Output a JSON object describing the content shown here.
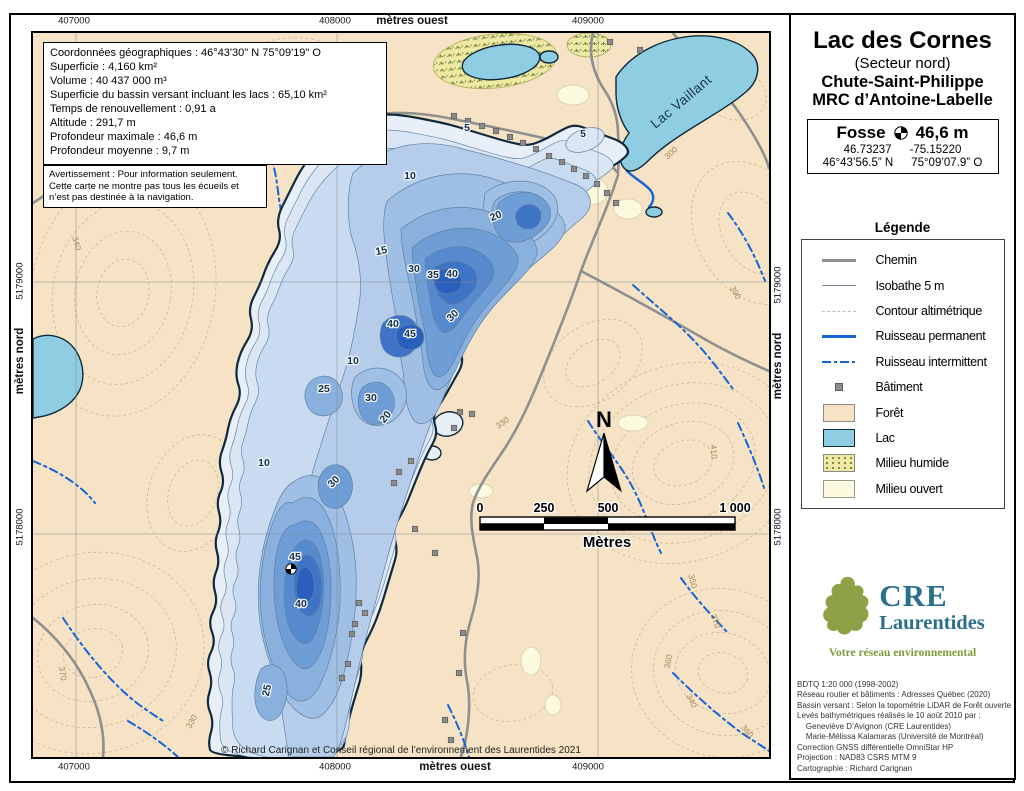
{
  "colors": {
    "forest": "#f6e3c5",
    "lake": "#8fcde3",
    "deep_blue": "#2a5fbd",
    "stream_blue": "#1565d8",
    "road_gray": "#8f8f8f",
    "logo_teal": "#2b6f8e",
    "logo_green": "#7d9c3c"
  },
  "map": {
    "axes": {
      "top": {
        "y": 21,
        "items": [
          {
            "t": "407000",
            "x": 74
          },
          {
            "t": "408000",
            "x": 335
          },
          {
            "t": "mètres ouest",
            "x": 412,
            "unit": true
          },
          {
            "t": "409000",
            "x": 588
          }
        ]
      },
      "bottom": {
        "y": 767,
        "items": [
          {
            "t": "407000",
            "x": 74
          },
          {
            "t": "408000",
            "x": 335
          },
          {
            "t": "mètres ouest",
            "x": 455,
            "unit": true
          },
          {
            "t": "409000",
            "x": 588
          }
        ]
      },
      "left": {
        "x": 20,
        "items": [
          {
            "t": "5179000",
            "y": 281
          },
          {
            "t": "mètres nord",
            "y": 361,
            "unit": true
          },
          {
            "t": "5178000",
            "y": 527
          }
        ]
      },
      "right": {
        "x": 778,
        "items": [
          {
            "t": "5179000",
            "y": 285
          },
          {
            "t": "mètres nord",
            "y": 366,
            "unit": true
          },
          {
            "t": "5178000",
            "y": 527
          }
        ]
      }
    },
    "info_box": {
      "lines": [
        "Coordonnées géographiques : 46°43'30\" N   75°09'19\" O",
        "Superficie : 4,160 km²",
        "Volume : 40 437 000 m³",
        "Superficie du bassin versant incluant les lacs : 65,10 km²",
        "Temps de renouvellement : 0,91 a",
        "Altitude : 291,7 m",
        "Profondeur maximale : 46,6 m",
        "Profondeur moyenne : 9,7 m"
      ]
    },
    "warning_box": {
      "lines": [
        "Avertissement : Pour information seulement.",
        "Cette carte ne montre pas tous les écueils et",
        "n’est pas destinée à la navigation."
      ]
    },
    "copyright": "© Richard Carignan et Conseil régional de l’environnement des Laurentides 2021",
    "lake_vaillant_label": "Lac Vaillant",
    "north_label": "N",
    "scalebar": {
      "ticks": [
        {
          "t": "0",
          "x": 447
        },
        {
          "t": "250",
          "x": 511
        },
        {
          "t": "500",
          "x": 575
        },
        {
          "t": "1 000",
          "x": 702
        }
      ],
      "unit": "Mètres"
    },
    "depth_labels": [
      {
        "v": "5",
        "x": 550,
        "y": 104
      },
      {
        "v": "5",
        "x": 434,
        "y": 98
      },
      {
        "v": "10",
        "x": 377,
        "y": 146
      },
      {
        "v": "15",
        "x": 349,
        "y": 221,
        "r": -12
      },
      {
        "v": "20",
        "x": 464,
        "y": 186,
        "r": -22
      },
      {
        "v": "30",
        "x": 381,
        "y": 239
      },
      {
        "v": "35",
        "x": 400,
        "y": 245
      },
      {
        "v": "40",
        "x": 419,
        "y": 244
      },
      {
        "v": "40",
        "x": 360,
        "y": 294
      },
      {
        "v": "45",
        "x": 377,
        "y": 304
      },
      {
        "v": "30",
        "x": 422,
        "y": 285,
        "r": -45
      },
      {
        "v": "10",
        "x": 320,
        "y": 331
      },
      {
        "v": "25",
        "x": 291,
        "y": 359
      },
      {
        "v": "30",
        "x": 338,
        "y": 368
      },
      {
        "v": "20",
        "x": 355,
        "y": 386,
        "r": -50
      },
      {
        "v": "10",
        "x": 231,
        "y": 433
      },
      {
        "v": "30",
        "x": 303,
        "y": 451,
        "r": -45
      },
      {
        "v": "45",
        "x": 262,
        "y": 527
      },
      {
        "v": "40",
        "x": 268,
        "y": 574
      },
      {
        "v": "25",
        "x": 237,
        "y": 658,
        "r": -78
      }
    ],
    "elevation_labels": [
      {
        "v": "300",
        "x": 640,
        "y": 122,
        "r": -42
      },
      {
        "v": "330",
        "x": 471,
        "y": 392,
        "r": -35
      },
      {
        "v": "410",
        "x": 678,
        "y": 419,
        "r": 85
      },
      {
        "v": "350",
        "x": 657,
        "y": 549,
        "r": 75
      },
      {
        "v": "370",
        "x": 680,
        "y": 589,
        "r": 70
      },
      {
        "v": "360",
        "x": 638,
        "y": 629,
        "r": -80
      },
      {
        "v": "340",
        "x": 656,
        "y": 669,
        "r": 65
      },
      {
        "v": "380",
        "x": 222,
        "y": 156,
        "r": -30
      },
      {
        "v": "320",
        "x": 60,
        "y": 119,
        "r": 40
      },
      {
        "v": "340",
        "x": 41,
        "y": 211,
        "r": 75
      },
      {
        "v": "390",
        "x": 700,
        "y": 261,
        "r": 60
      },
      {
        "v": "360",
        "x": 712,
        "y": 700,
        "r": 50
      },
      {
        "v": "330",
        "x": 161,
        "y": 690,
        "r": -60
      },
      {
        "v": "370",
        "x": 27,
        "y": 641,
        "r": 80
      }
    ],
    "buildings": [
      [
        421,
        83
      ],
      [
        435,
        88
      ],
      [
        449,
        93
      ],
      [
        463,
        98
      ],
      [
        477,
        104
      ],
      [
        490,
        110
      ],
      [
        503,
        116
      ],
      [
        516,
        123
      ],
      [
        529,
        129
      ],
      [
        541,
        136
      ],
      [
        553,
        143
      ],
      [
        564,
        151
      ],
      [
        574,
        160
      ],
      [
        583,
        170
      ],
      [
        577,
        9
      ],
      [
        607,
        17
      ],
      [
        378,
        428
      ],
      [
        366,
        439
      ],
      [
        361,
        450
      ],
      [
        382,
        496
      ],
      [
        402,
        520
      ],
      [
        427,
        379
      ],
      [
        439,
        381
      ],
      [
        421,
        395
      ],
      [
        326,
        570
      ],
      [
        332,
        580
      ],
      [
        322,
        591
      ],
      [
        319,
        601
      ],
      [
        315,
        631
      ],
      [
        309,
        645
      ],
      [
        430,
        600
      ],
      [
        426,
        640
      ],
      [
        412,
        687
      ],
      [
        418,
        707
      ]
    ]
  },
  "panel": {
    "title": "Lac des Cornes",
    "subtitle": "(Secteur nord)",
    "municipality": "Chute-Saint-Philippe",
    "mrc": "MRC d’Antoine-Labelle",
    "fosse": {
      "label": "Fosse",
      "depth": "46,6 m",
      "lat_dec": "46.73237",
      "lon_dec": "-75.15220",
      "lat_dms": "46°43’56.5” N",
      "lon_dms": "75°09’07.9” O"
    },
    "legend": {
      "title": "Légende",
      "items": [
        {
          "label": "Chemin",
          "swatch": "chemin"
        },
        {
          "label": "Isobathe 5 m",
          "swatch": "isobathe"
        },
        {
          "label": "Contour altimétrique",
          "swatch": "contour"
        },
        {
          "label": "Ruisseau permanent",
          "swatch": "rperm"
        },
        {
          "label": "Ruisseau intermittent",
          "swatch": "rint"
        },
        {
          "label": "Bâtiment",
          "swatch": "batiment"
        },
        {
          "label": "Forêt",
          "swatch": "foret"
        },
        {
          "label": "Lac",
          "swatch": "lac"
        },
        {
          "label": "Milieu humide",
          "swatch": "humide"
        },
        {
          "label": "Milieu ouvert",
          "swatch": "ouvert"
        }
      ]
    },
    "logo": {
      "acronym": "CRE",
      "name": "Laurentides",
      "tagline": "Votre réseau environnemental"
    },
    "credits": {
      "lines": [
        "BDTQ 1:20 000 (1998-2002)",
        "Réseau routier et bâtiments : Adresses Québec (2020)",
        "Bassin versant : Selon la topométrie LiDAR de Forêt ouverte",
        "Levés bathymétriques réalisés le 10 août 2010 par :",
        "    Geneviève D’Avignon (CRE Laurentides)",
        "    Marie-Mélissa Kalamaras (Université de Montréal)",
        "Correction GNSS différentielle OmniStar HP",
        "Projection : NAD83 CSRS MTM 9",
        "Cartographie : Richard Carignan"
      ]
    }
  }
}
